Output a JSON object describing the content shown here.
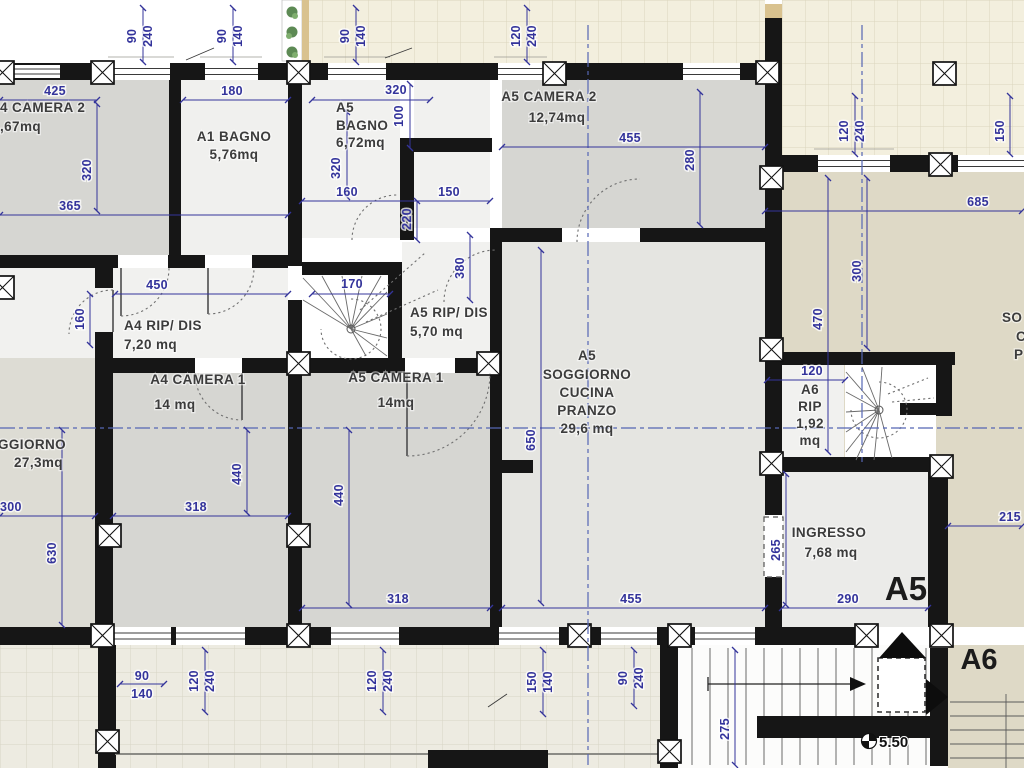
{
  "plan_type": "residential floor plan",
  "units": {
    "a5_label": "A5",
    "a6_label": "A6"
  },
  "rooms": {
    "a4_camera2": {
      "name": "4 CAMERA 2",
      "area": ",67mq"
    },
    "a1_bagno": {
      "name": "A1 BAGNO",
      "area": "5,76mq"
    },
    "a5_bagno": {
      "l1": "A5",
      "l2": "BAGNO",
      "area": "6,72mq"
    },
    "a5_camera2": {
      "name": "A5 CAMERA 2",
      "area": "12,74mq"
    },
    "a4_rip": {
      "name": "A4 RIP/ DIS",
      "area": "7,20 mq"
    },
    "a5_rip": {
      "name": "A5 RIP/ DIS",
      "area": "5,70 mq"
    },
    "a4_camera1": {
      "name": "A4 CAMERA 1",
      "area": "14 mq"
    },
    "a5_camera1": {
      "name": "A5 CAMERA 1",
      "area": "14mq"
    },
    "a5_soggiorno": {
      "l1": "A5",
      "l2": "SOGGIORNO",
      "l3": "CUCINA",
      "l4": "PRANZO",
      "area": "29,6 mq"
    },
    "soggiorno_left": {
      "name": "GGIORNO",
      "area": "27,3mq"
    },
    "a6_rip": {
      "l1": "A6",
      "l2": "RIP",
      "l3": "1,92",
      "l4": "mq"
    },
    "ingresso": {
      "name": "INGRESSO",
      "area": "7,68 mq"
    },
    "a6_soggiorno_clipped": {
      "f1": "SO",
      "f2": "C",
      "f3": "P"
    }
  },
  "level_marker": {
    "value": "5.50"
  },
  "dims": {
    "d90": "90",
    "d100": "100",
    "d120": "120",
    "d140": "140",
    "d150": "150",
    "d160": "160",
    "d170": "170",
    "d180": "180",
    "d215": "215",
    "d220": "220",
    "d240": "240",
    "d265": "265",
    "d275": "275",
    "d280": "280",
    "d290": "290",
    "d300": "300",
    "d318": "318",
    "d320": "320",
    "d365": "365",
    "d380": "380",
    "d425": "425",
    "d440": "440",
    "d450": "450",
    "d455": "455",
    "d470": "470",
    "d630": "630",
    "d650": "650",
    "d685": "685"
  },
  "colors": {
    "dim_blue": "#34349b",
    "wall": "#161616",
    "camera_gray": "#d6d6d2",
    "terrace_tile": "#f3efde",
    "balcony_tile": "#edebe1",
    "beige": "#ded9c6"
  }
}
